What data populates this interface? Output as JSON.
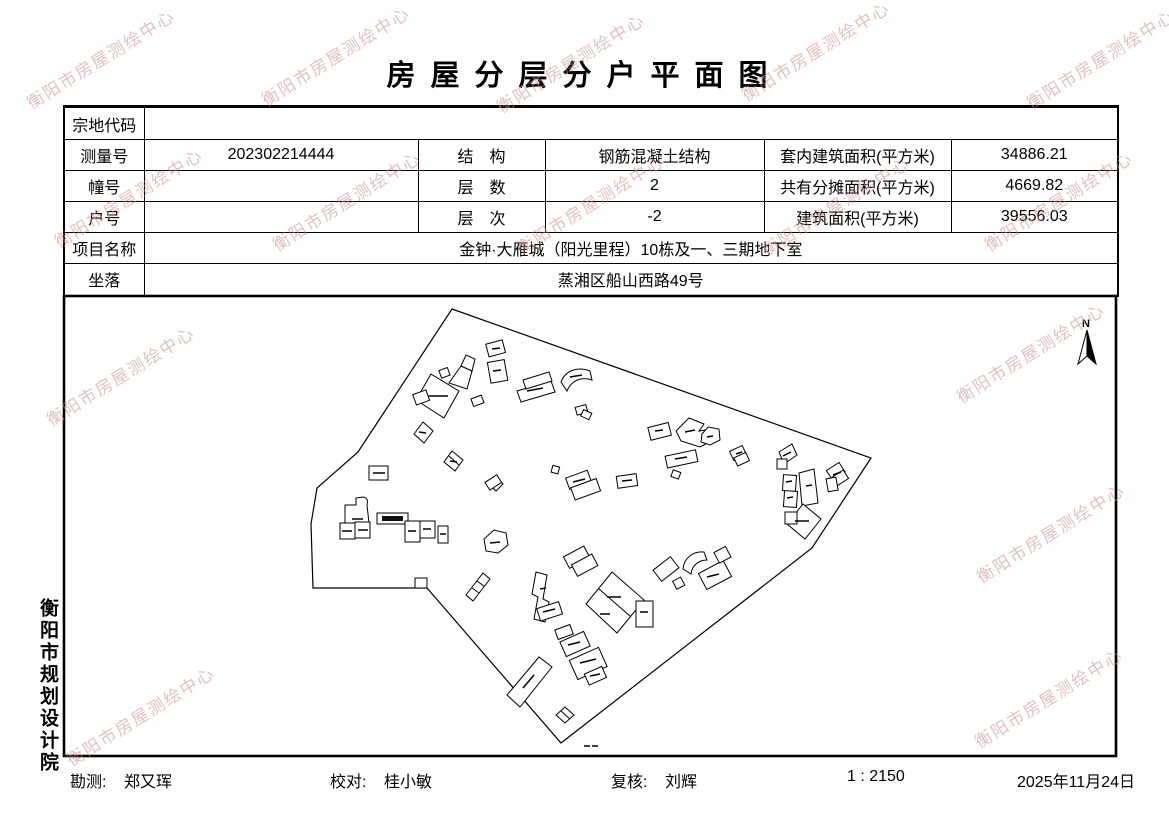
{
  "watermark": {
    "text": "衡阳市房屋测绘中心"
  },
  "title": {
    "text": "房屋分层分户平面图"
  },
  "table": {
    "parcel_code_label": "宗地代码",
    "parcel_code_value": "",
    "survey_no_label": "测量号",
    "survey_no_value": "202302214444",
    "structure_label": "结　构",
    "structure_value": "钢筋混凝土结构",
    "inner_area_label": "套内建筑面积(平方米)",
    "inner_area_value": "34886.21",
    "building_no_label": "幢号",
    "building_no_value": "",
    "floors_label": "层　数",
    "floors_value": "2",
    "shared_area_label": "共有分摊面积(平方米)",
    "shared_area_value": "4669.82",
    "unit_no_label": "户号",
    "unit_no_value": "",
    "level_label": "层　次",
    "level_value": "-2",
    "total_area_label": "建筑面积(平方米)",
    "total_area_value": "39556.03",
    "project_name_label": "项目名称",
    "project_name_value": "金钟·大雁城（阳光里程）10栋及一、三期地下室",
    "location_label": "坐落",
    "location_value": "蒸湘区船山西路49号"
  },
  "map": {
    "north_label": "N"
  },
  "side": {
    "institute": "衡阳市规划设计院"
  },
  "footer": {
    "survey_label": "勘测:",
    "survey_value": "郑又珲",
    "check_label": "校对:",
    "check_value": "桂小敏",
    "review_label": "复核:",
    "review_value": "刘辉",
    "scale": "1 : 2150",
    "date": "2025年11月24日"
  }
}
